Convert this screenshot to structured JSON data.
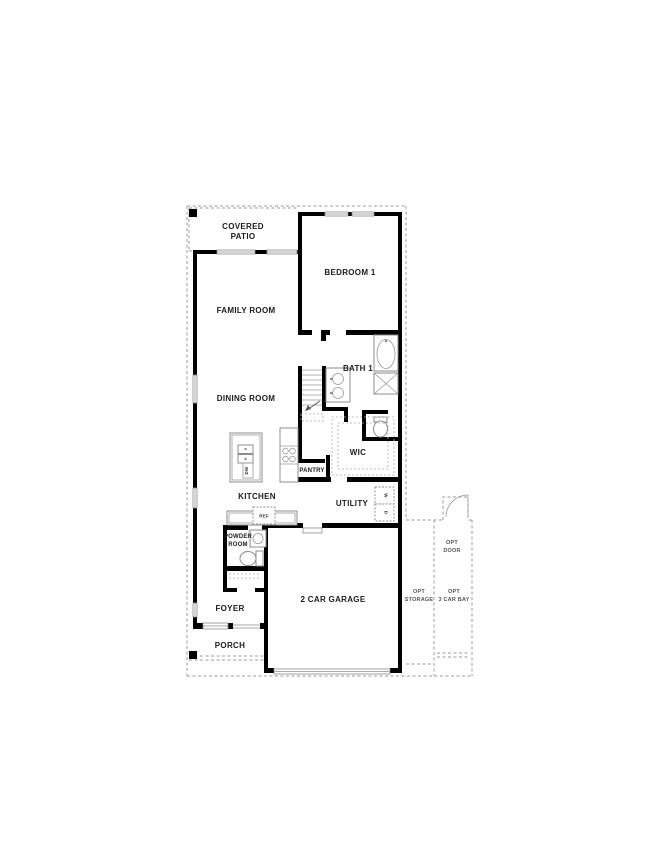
{
  "plan": {
    "type": "single-family home first floor plan",
    "colors": {
      "wall": "#000000",
      "fixture_outline": "#8c8c8c",
      "dashed_optional": "#9b9b9b",
      "label_text": "#1c1c1c",
      "background": "#ffffff"
    },
    "rooms": {
      "covered_patio": {
        "line1": "COVERED",
        "line2": "PATIO"
      },
      "bedroom_1": "BEDROOM 1",
      "family_room": "FAMILY ROOM",
      "bath_1": "BATH 1",
      "dining_room": "DINING ROOM",
      "wic": "WIC",
      "pantry": "PANTRY",
      "kitchen": "KITCHEN",
      "utility": "UTILITY",
      "powder_room": {
        "line1": "POWDER",
        "line2": "ROOM"
      },
      "foyer": "FOYER",
      "porch": "PORCH",
      "garage": "2 CAR GARAGE"
    },
    "appliances": {
      "ref": "REF",
      "dw": "DW",
      "washer": "W",
      "dryer": "D"
    },
    "options": {
      "storage": {
        "line1": "OPT",
        "line2": "STORAGE"
      },
      "three_car_bay": {
        "line1": "OPT",
        "line2": "3 CAR BAY"
      },
      "door": {
        "line1": "OPT",
        "line2": "DOOR"
      }
    }
  }
}
